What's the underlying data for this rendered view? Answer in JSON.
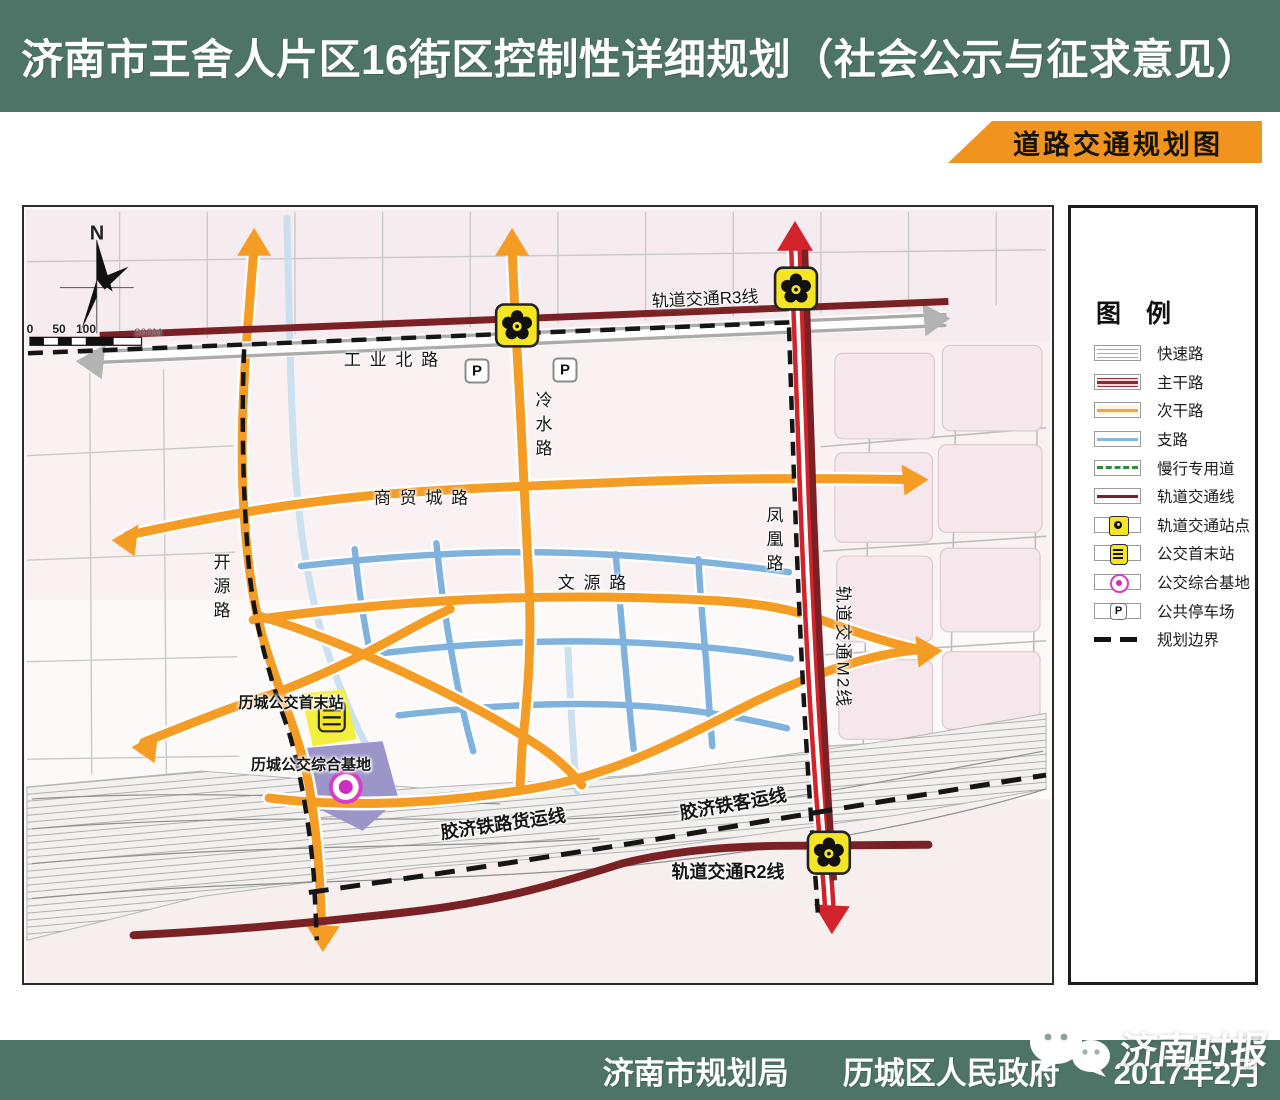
{
  "header": {
    "title": "济南市王舍人片区16街区控制性详细规划（社会公示与征求意见）",
    "banner": "道路交通规划图"
  },
  "map": {
    "north_label": "N",
    "scale": {
      "ticks": [
        "0",
        "50",
        "100"
      ],
      "end_label": "200M"
    },
    "roads": {
      "industrial_north_road": "工 业 北 路",
      "rail_r3": "轨道交通R3线",
      "lengshui_road": "冷水路",
      "kaiyuan_road": "开源路",
      "shangmao_city_road": "商 贸 城 路",
      "wenyuan_road": "文 源 路",
      "fenghuang_road": "凤凰路",
      "rail_m2": "轨道交通M2线",
      "rail_r2": "轨道交通R2线",
      "jiaoji_freight_line": "胶济铁路货运线",
      "jiaoji_passenger_line": "胶济铁客运线"
    },
    "facilities": {
      "bus_terminal": "历城公交首末站",
      "bus_base": "历城公交综合基地",
      "parking_label": "P"
    }
  },
  "legend": {
    "title": "图  例",
    "items": [
      {
        "label": "快速路"
      },
      {
        "label": "主干路"
      },
      {
        "label": "次干路"
      },
      {
        "label": "支路"
      },
      {
        "label": "慢行专用道"
      },
      {
        "label": "轨道交通线"
      },
      {
        "label": "轨道交通站点"
      },
      {
        "label": "公交首末站"
      },
      {
        "label": "公交综合基地"
      },
      {
        "label": "公共停车场"
      },
      {
        "label": "规划边界"
      }
    ]
  },
  "footer": {
    "agency_1": "济南市规划局",
    "agency_2": "历城区人民政府",
    "date": "2017年2月",
    "watermark": "济南时报"
  },
  "colors": {
    "header_bg": "#4e7468",
    "banner_bg": "#f0931f",
    "expressway_gray": "#ababab",
    "main_road_red": "#d2232a",
    "secondary_orange": "#f59c25",
    "branch_blue": "#7fb2dc",
    "slow_lane_green": "#2e8b3d",
    "rail_maroon": "#7a2125",
    "station_yellow": "#f5e524",
    "bus_base_magenta": "#cc2fbf",
    "boundary_black": "#151515"
  }
}
